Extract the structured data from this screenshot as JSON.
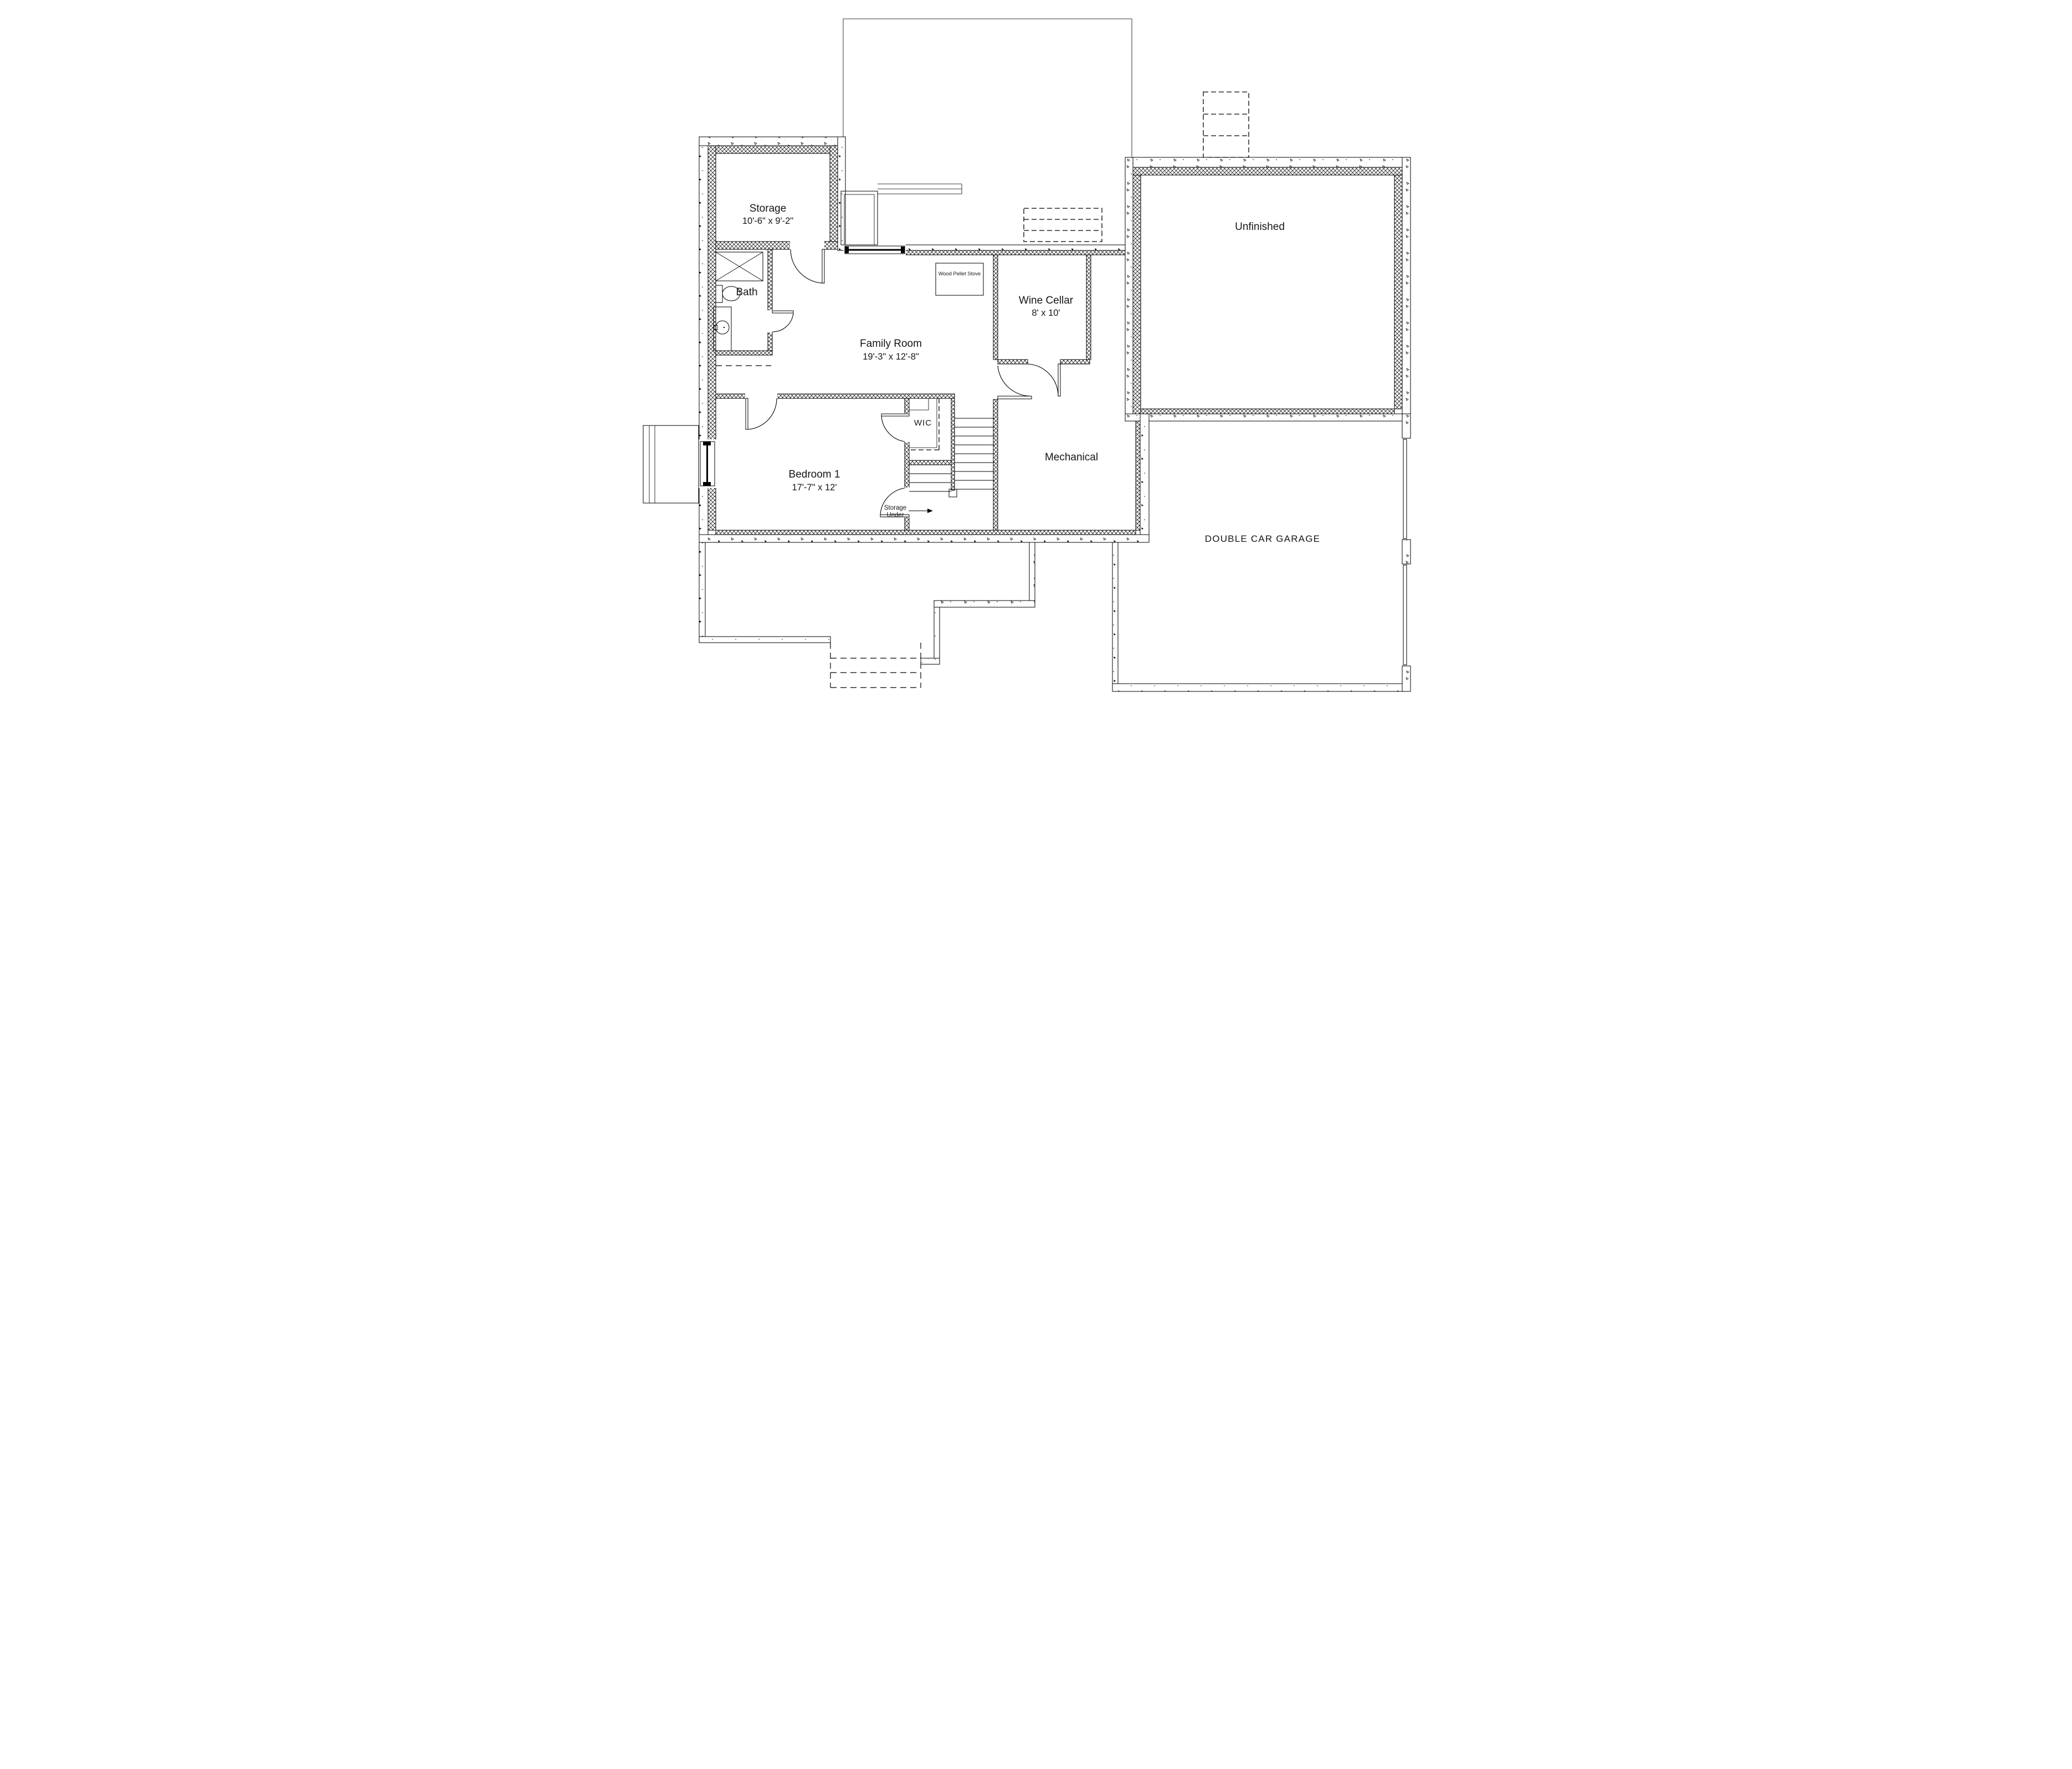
{
  "title": "Basement Floor Plan",
  "colors": {
    "ink": "#000000",
    "paper": "#ffffff"
  },
  "rooms": {
    "storage": {
      "name": "Storage",
      "dims": "10'-6\" x 9'-2\""
    },
    "bath": {
      "name": "Bath"
    },
    "family_room": {
      "name": "Family Room",
      "dims": "19'-3\" x 12'-8\""
    },
    "wine_cellar": {
      "name": "Wine Cellar",
      "dims": "8' x 10'"
    },
    "unfinished": {
      "name": "Unfinished"
    },
    "wic": {
      "name": "WIC"
    },
    "bedroom1": {
      "name": "Bedroom 1",
      "dims": "17'-7\" x 12'"
    },
    "storage_under": {
      "line1": "Storage",
      "line2": "Under"
    },
    "mechanical": {
      "name": "Mechanical"
    },
    "garage": {
      "name": "DOUBLE CAR GARAGE"
    }
  },
  "fixtures": {
    "stove": {
      "label": "Wood Pellet Stove"
    }
  }
}
